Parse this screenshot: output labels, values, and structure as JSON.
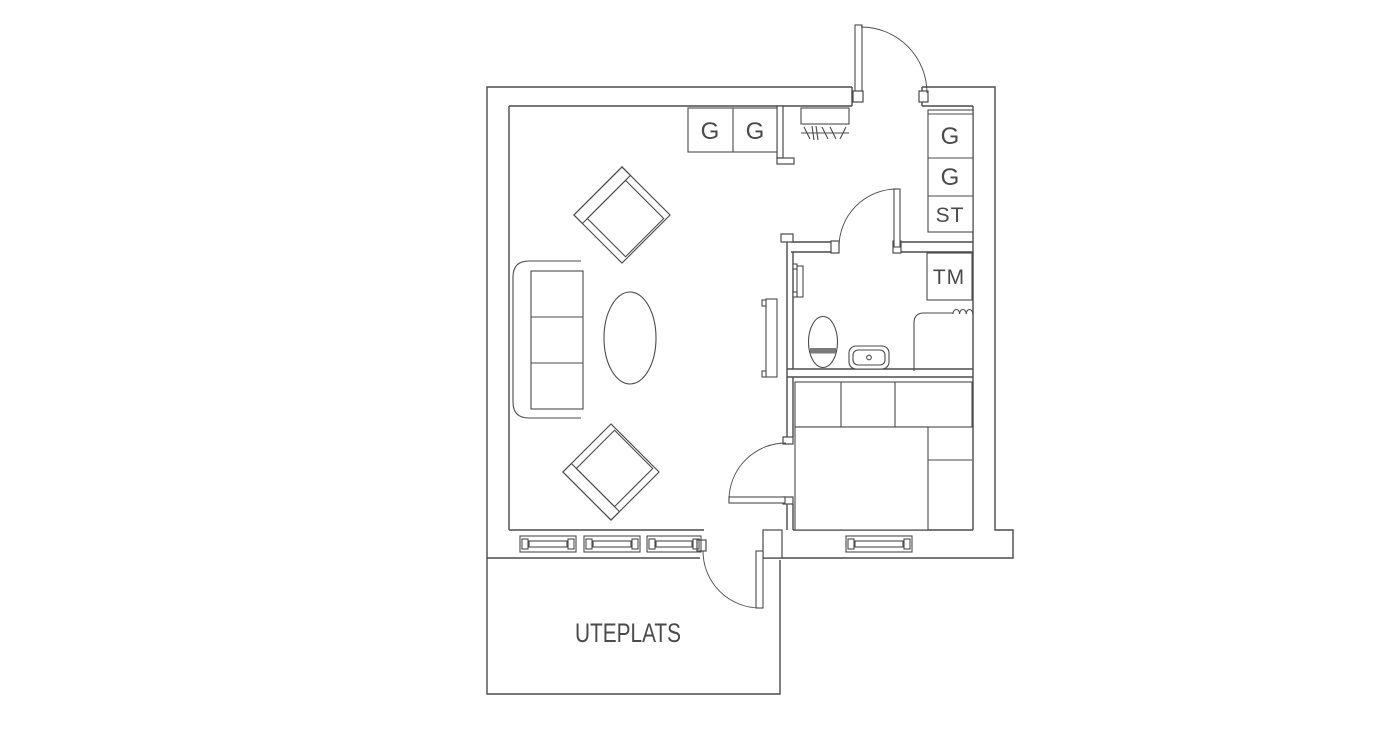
{
  "plan": {
    "labels": {
      "patio": "UTEPLATS",
      "top_wardrobes": [
        "G",
        "G"
      ],
      "hall_wardrobes": [
        "G",
        "G",
        "ST"
      ],
      "washing_machine": "TM"
    },
    "colors": {
      "line": "#4a4a4a",
      "background": "#ffffff"
    }
  }
}
